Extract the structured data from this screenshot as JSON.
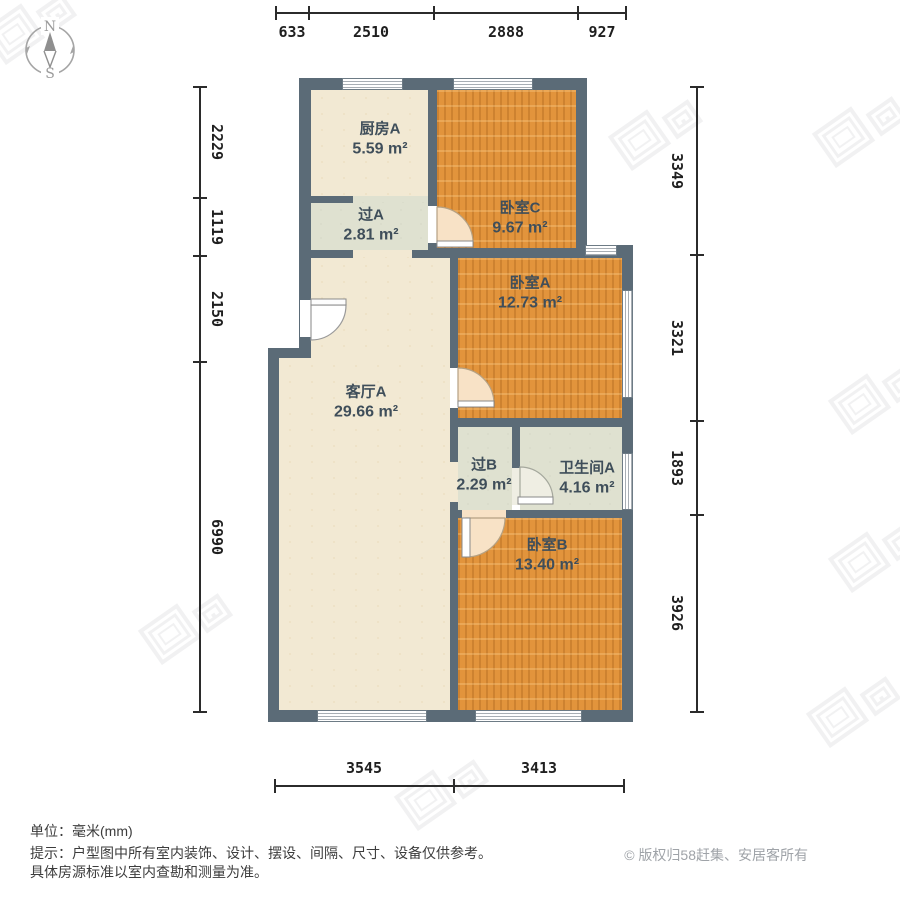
{
  "compass": {
    "north": "N",
    "south": "S"
  },
  "rooms": {
    "kitchen_a": {
      "name": "厨房A",
      "area": "5.59 m²"
    },
    "hall_a": {
      "name": "过A",
      "area": "2.81 m²"
    },
    "bedroom_c": {
      "name": "卧室C",
      "area": "9.67 m²"
    },
    "bedroom_a": {
      "name": "卧室A",
      "area": "12.73 m²"
    },
    "living_a": {
      "name": "客厅A",
      "area": "29.66 m²"
    },
    "hall_b": {
      "name": "过B",
      "area": "2.29 m²"
    },
    "bathroom_a": {
      "name": "卫生间A",
      "area": "4.16 m²"
    },
    "bedroom_b": {
      "name": "卧室B",
      "area": "13.40 m²"
    }
  },
  "dimensions": {
    "top": [
      "633",
      "2510",
      "2888",
      "927"
    ],
    "left": [
      "2229",
      "1119",
      "2150",
      "6990"
    ],
    "right": [
      "3349",
      "3321",
      "1893",
      "3926"
    ],
    "bottom": [
      "3545",
      "3413"
    ]
  },
  "footer": {
    "unit": "单位：毫米(mm)",
    "tip_line1": "提示：户型图中所有室内装饰、设计、摆设、间隔、尺寸、设备仅供参考。",
    "tip_line2": "具体房源标准以室内查勘和测量为准。",
    "copyright": "© 版权归58赶集、安居客所有"
  },
  "colors": {
    "wall": "#5b6b77",
    "bedroom_floor": "#e2943c",
    "living_floor": "#f2e9d3",
    "hall_floor": "#dfe1d0",
    "dimension_text": "#1f1f1f",
    "room_label_text": "#3f4e5a",
    "copyright_text": "#9fa3a8"
  }
}
